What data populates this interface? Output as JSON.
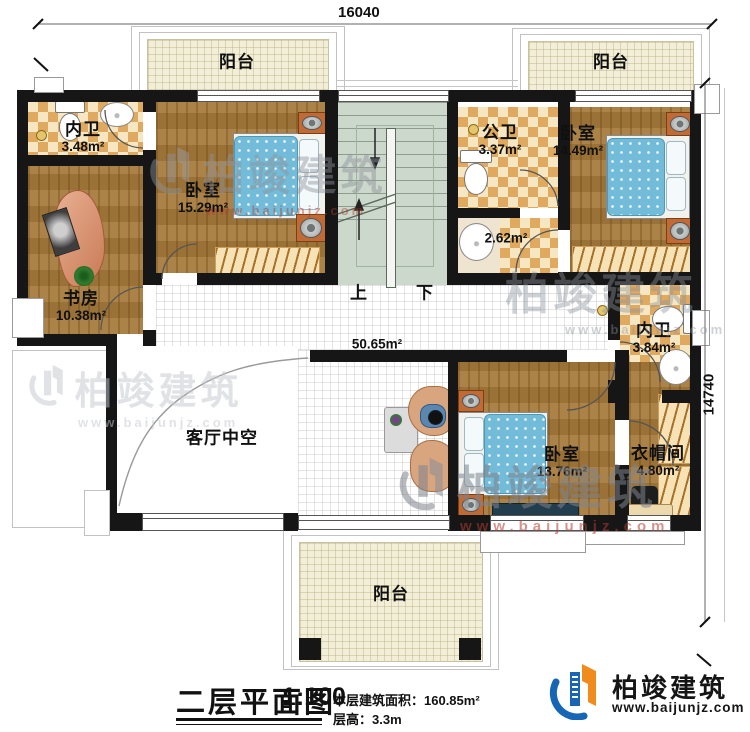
{
  "dimensions": {
    "width_top": "16040",
    "height_right": "14740"
  },
  "stairs": {
    "up": "上",
    "down": "下"
  },
  "rooms": {
    "balcony_tl": {
      "label": "阳台"
    },
    "balcony_tr": {
      "label": "阳台"
    },
    "balcony_b": {
      "label": "阳台"
    },
    "bath1": {
      "label": "内卫",
      "area": "3.48m²"
    },
    "bedroom1": {
      "label": "卧室",
      "area": "15.29m²"
    },
    "pubbath": {
      "label": "公卫",
      "area": "3.37m²"
    },
    "wash": {
      "area": "2.62m²"
    },
    "bedroom2": {
      "label": "卧室",
      "area": "14.49m²"
    },
    "study": {
      "label": "书房",
      "area": "10.38m²"
    },
    "hall": {
      "area": "50.65m²"
    },
    "void": {
      "label": "客厅中空"
    },
    "bath2": {
      "label": "内卫",
      "area": "3.84m²"
    },
    "bedroom3": {
      "label": "卧室",
      "area": "13.76m²"
    },
    "cloak": {
      "label": "衣帽间",
      "area": "4.80m²"
    }
  },
  "title_block": {
    "title": "二层平面图",
    "scale": "1:100",
    "area_line": "本层建筑面积：160.85m²",
    "height_line": "层高：3.3m"
  },
  "brand": {
    "name": "柏竣建筑",
    "url": "www.baijunjz.com"
  },
  "watermark": {
    "name": "柏竣建筑",
    "url": "www.baijunjz.com"
  },
  "colors": {
    "wall": "#161616",
    "wood": "#a57b3e",
    "checker_tan": "#dfa95f",
    "balcony_tile": "#f2eed8",
    "stairs": "#cdd8cc",
    "bed_blue": "#72bcd9",
    "brand_blue": "#1766b5",
    "brand_orange": "#f08c1e",
    "watermark_red": "#b23b30"
  }
}
